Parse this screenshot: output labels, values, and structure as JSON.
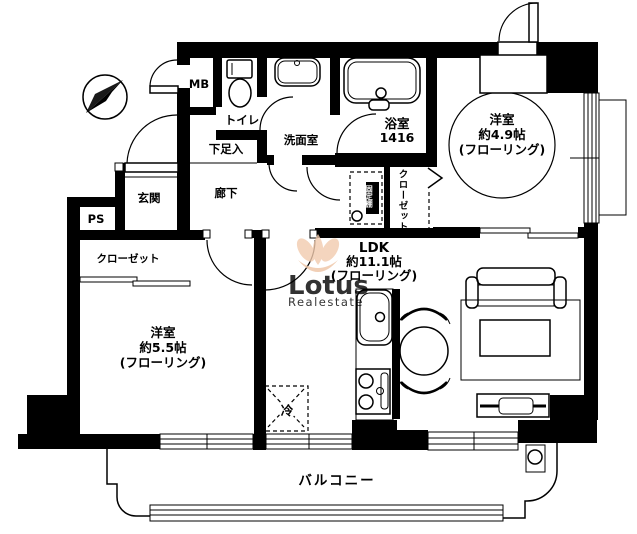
{
  "plan": {
    "labels": {
      "mb": "MB",
      "toilet": "トイレ",
      "washroom": "洗面室",
      "bathroom": {
        "name": "浴室",
        "size": "1416"
      },
      "bedroom1": {
        "l1": "洋室",
        "l2": "約4.9帖",
        "l3": "(フローリング)"
      },
      "bedroom2": {
        "l1": "洋室",
        "l2": "約5.5帖",
        "l3": "(フローリング)"
      },
      "ldk": {
        "l1": "LDK",
        "l2": "約11.1帖",
        "l3": "(フローリング)"
      },
      "shoe_cabinet": "下足入",
      "hallway": "廊下",
      "entrance": "玄関",
      "pipe_space": "PS",
      "closet_left": "クローゼット",
      "closet_right": "クローゼット",
      "movable_shelf": "可動棚",
      "fixed_shelf": "固定棚",
      "refrigerator": "冷",
      "balcony": "バルコニー"
    },
    "watermark": {
      "brand": "Lotus",
      "suffix": "Realestate"
    },
    "colors": {
      "wall": "#000000",
      "background": "#ffffff",
      "watermark_gray": "#c1c1c1",
      "watermark_tan": "#e3bda0",
      "watermark_flower": "#f2cbae"
    }
  }
}
